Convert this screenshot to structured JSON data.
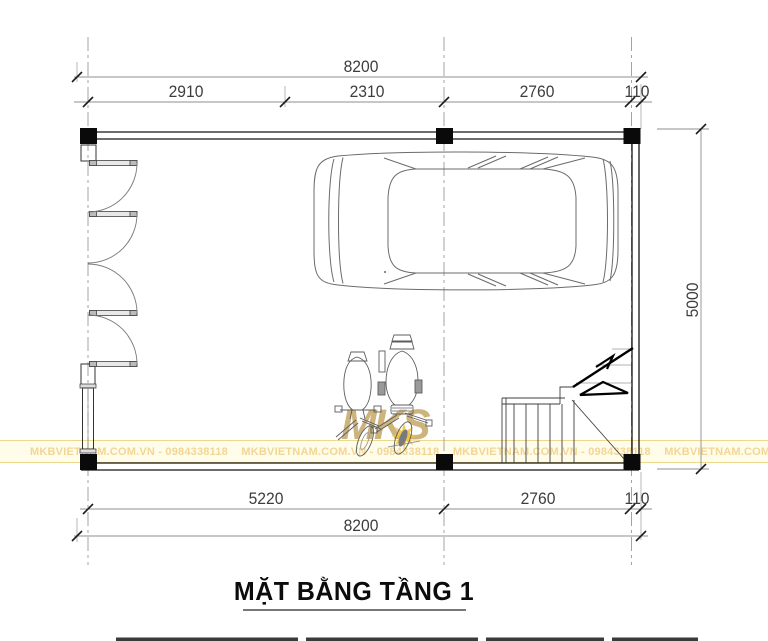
{
  "page": {
    "background": "#ffffff"
  },
  "title": {
    "text": "MẶT BẰNG TẦNG 1"
  },
  "dimensions": {
    "top": {
      "total": "8200",
      "segments": [
        "2910",
        "2310",
        "2760",
        "110"
      ]
    },
    "bottom": {
      "segments": [
        "5220",
        "2760",
        "110"
      ],
      "total": "8200"
    },
    "right": {
      "total": "5000"
    }
  },
  "watermark": {
    "logo_text": "MKS",
    "band_text": "MKBVIETNAM.COM.VN - 0984338118",
    "colors": {
      "band_background": "#fffcea",
      "band_border": "#ecd98e",
      "band_text": "#f2d694",
      "logo": "#bf9d57",
      "star": "#f0c440"
    }
  },
  "drawing": {
    "line_color": "#5c5c5c",
    "wall_color": "#141414",
    "dim_line_color": "#8f8f8f",
    "grid_line_color": "#9a9a9a",
    "symbols": [
      "car",
      "motorbike",
      "motorbike",
      "folding-doors",
      "window",
      "staircase",
      "stair-direction-arrow",
      "columns"
    ]
  }
}
